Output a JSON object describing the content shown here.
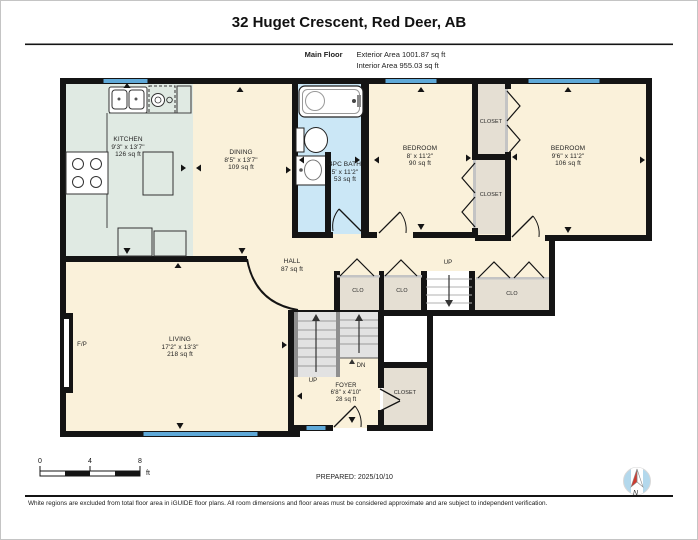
{
  "header": {
    "title": "32 Huget Crescent, Red Deer, AB",
    "floor_label": "Main Floor",
    "exterior_area": "Exterior Area 1001.87 sq ft",
    "interior_area": "Interior Area 955.03 sq ft"
  },
  "rooms": {
    "kitchen": {
      "name": "KITCHEN",
      "dims": "9'3\" x 13'7\"",
      "area": "126 sq ft"
    },
    "dining": {
      "name": "DINING",
      "dims": "8'5\" x 13'7\"",
      "area": "109 sq ft"
    },
    "bath": {
      "name": "4PC BATH",
      "dims": "5' x 11'2\"",
      "area": "53 sq ft"
    },
    "bedroom_left": {
      "name": "BEDROOM",
      "dims": "8' x 11'2\"",
      "area": "90 sq ft"
    },
    "bedroom_right": {
      "name": "BEDROOM",
      "dims": "9'6\" x 11'2\"",
      "area": "106 sq ft"
    },
    "hall": {
      "name": "HALL",
      "area": "87 sq ft"
    },
    "living": {
      "name": "LIVING",
      "dims": "17'2\" x 13'3\"",
      "area": "218 sq ft"
    },
    "foyer": {
      "name": "FOYER",
      "dims": "6'8\" x 4'10\"",
      "area": "28 sq ft"
    },
    "closet_top": {
      "name": "CLOSET"
    },
    "closet_bottom": {
      "name": "CLOSET"
    },
    "closet_foyer": {
      "name": "CLOSET"
    },
    "clo_1": {
      "name": "CLO"
    },
    "clo_2": {
      "name": "CLO"
    },
    "clo_3": {
      "name": "CLO"
    }
  },
  "annotations": {
    "up_hall": "UP",
    "up_stairs": "UP",
    "down_stairs": "DN",
    "fireplace": "F/P",
    "north": "N"
  },
  "scale_bar": {
    "t0": "0",
    "t4": "4",
    "t8": "8",
    "unit": "ft"
  },
  "footer": {
    "prepared": "PREPARED: 2025/10/10",
    "disclaimer": "White regions are excluded from total floor area in iGUIDE floor plans. All room dimensions and floor areas must be considered approximate and are subject to independent verification."
  },
  "colors": {
    "room_cream": "#FAF1DA",
    "kitchen_mint": "#E0EAE3",
    "bath_blue": "#CBE7F6",
    "closet_taupe": "#E5DFD3",
    "window_blue": "#5FA9D8",
    "wall_black": "#141414",
    "compass_blue": "#B3D8EC",
    "needle_red": "#CF3A30"
  }
}
